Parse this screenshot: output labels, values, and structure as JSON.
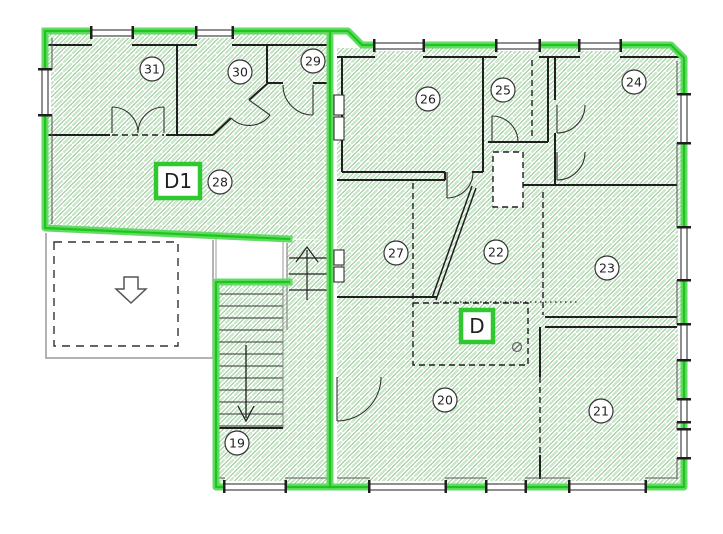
{
  "diagram": {
    "type": "architectural-floor-plan",
    "unit_labels": [
      {
        "id": "D1",
        "x": 156,
        "y": 164,
        "w": 44,
        "h": 34,
        "font": 20
      },
      {
        "id": "D",
        "x": 461,
        "y": 310,
        "w": 32,
        "h": 32,
        "font": 20
      }
    ],
    "rooms": [
      {
        "number": "19",
        "cx": 237,
        "cy": 443
      },
      {
        "number": "20",
        "cx": 445,
        "cy": 400
      },
      {
        "number": "21",
        "cx": 601,
        "cy": 411
      },
      {
        "number": "22",
        "cx": 496,
        "cy": 252
      },
      {
        "number": "23",
        "cx": 607,
        "cy": 268
      },
      {
        "number": "24",
        "cx": 634,
        "cy": 82
      },
      {
        "number": "25",
        "cx": 503,
        "cy": 90
      },
      {
        "number": "26",
        "cx": 428,
        "cy": 99
      },
      {
        "number": "27",
        "cx": 396,
        "cy": 253
      },
      {
        "number": "28",
        "cx": 220,
        "cy": 182
      },
      {
        "number": "29",
        "cx": 313,
        "cy": 61
      },
      {
        "number": "30",
        "cx": 240,
        "cy": 72
      },
      {
        "number": "31",
        "cx": 152,
        "cy": 69
      }
    ],
    "icons": [
      {
        "name": "down-arrow-hollow",
        "meaning": "opening below / void"
      },
      {
        "name": "stair-down-arrow",
        "meaning": "stair direction down"
      },
      {
        "name": "stair-up-arrow",
        "meaning": "stair direction up"
      },
      {
        "name": "diameter-symbol",
        "meaning": "pipe/duct mark"
      }
    ],
    "colors": {
      "boundary_green_glow": "#62db62",
      "boundary_green_core": "#1fc41f",
      "label_box_green": "#2fc92f",
      "hatch_green": "#c4ebc4",
      "hatch_gray": "#98b398",
      "wall_black": "#1f1f1f",
      "thin_gray": "#999999"
    }
  }
}
